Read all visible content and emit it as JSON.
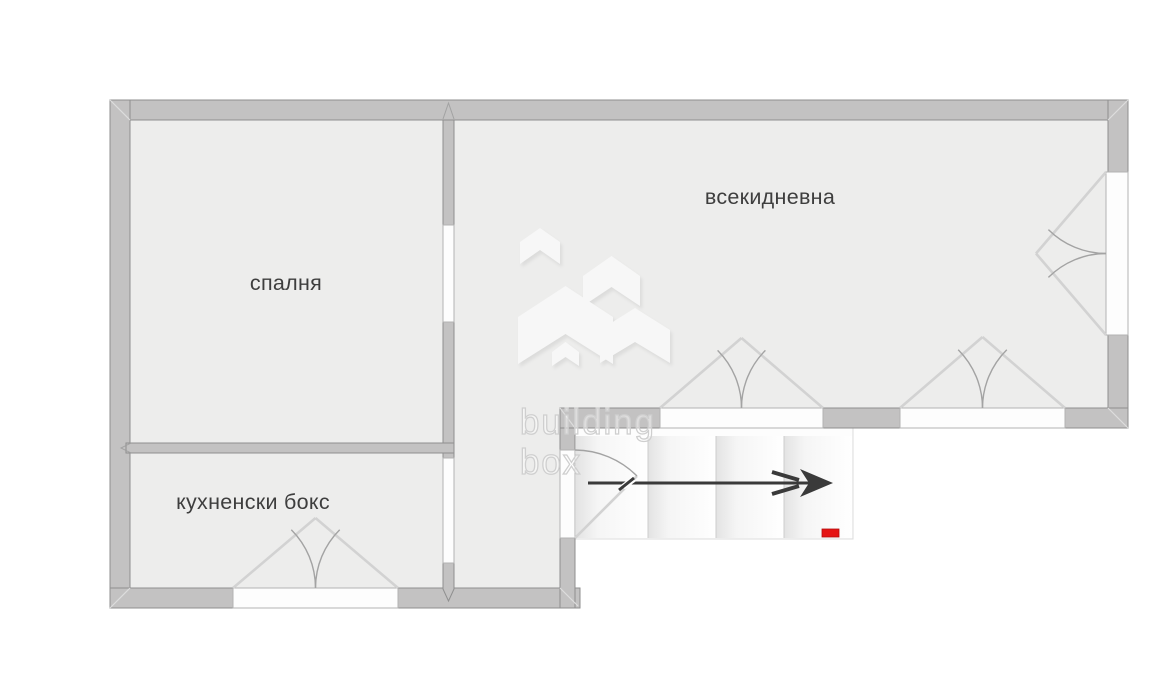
{
  "floor_plan": {
    "rooms": [
      {
        "name": "bedroom",
        "label": "спалня"
      },
      {
        "name": "living-room",
        "label": "всекидневна"
      },
      {
        "name": "kitchenette",
        "label": "кухненски бокс"
      }
    ],
    "watermark": {
      "line1": "building",
      "line2": "box"
    },
    "elements": [
      {
        "name": "french-door",
        "wall": "right-exterior"
      },
      {
        "name": "french-door",
        "wall": "living-room-bottom-left"
      },
      {
        "name": "french-window",
        "wall": "living-room-bottom-right"
      },
      {
        "name": "french-window",
        "wall": "kitchenette-bottom"
      },
      {
        "name": "interior-opening",
        "between": "bedroom/living-room"
      },
      {
        "name": "interior-opening",
        "between": "kitchenette/hallway"
      },
      {
        "name": "single-door",
        "between": "hallway/stairs"
      },
      {
        "name": "stairs",
        "steps": 4,
        "direction_arrow": "right"
      },
      {
        "name": "entrance-marker",
        "color": "red"
      }
    ],
    "colors": {
      "wall": "#c3c2c2",
      "wall_border": "#8f8f8f",
      "floor": "#ededec",
      "opening_border": "#b3b3b3",
      "door_symbol": "#a3a3a3",
      "door_leaf": "#d2d2d2",
      "stairs_fill": "#fbfbfb",
      "arrow": "#3a3a3a",
      "entrance_marker": "#e51414",
      "label_text": "#3e3e3e",
      "watermark_text": "#cfcfcf",
      "logo_shape": "#f7f7f7",
      "outside": "#ffffff"
    }
  }
}
